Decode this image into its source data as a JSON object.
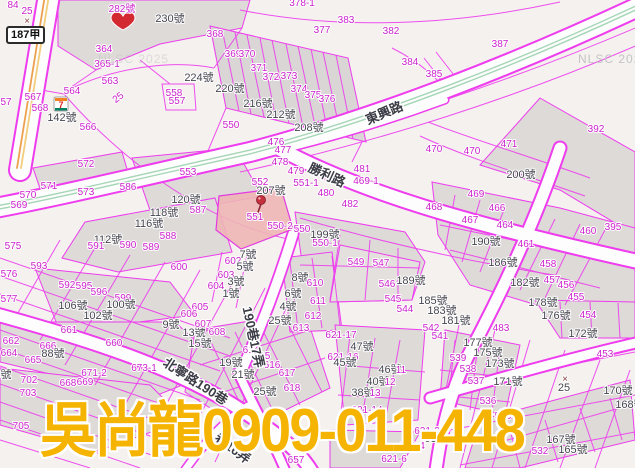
{
  "map": {
    "watermark_big": "吳尚龍0909-011-448",
    "nlsc_watermark": "NLSC 2025",
    "road_sign": "187甲",
    "highlight_parcel": "551",
    "colors": {
      "parcel_line": "#ee3cee",
      "parcel_number": "#cb1fcb",
      "house_number": "#45454f",
      "road_fill": "#fdfdfd",
      "block_fill": "#dddad8",
      "highlight_fill": "#eeb5b5",
      "watermark_gold": "#f6b402",
      "marker_red": "#d32a32",
      "highway_yellow": "#eda14f",
      "center_green": "#a5d6b5",
      "nlsc_gray": "#c4c4c4"
    },
    "markers": [
      {
        "name": "heart-marker",
        "near": "282號"
      },
      {
        "name": "pushpin-marker",
        "near": "551"
      },
      {
        "name": "seven-eleven-store",
        "near": "142號",
        "store_glyph": "7"
      }
    ],
    "labels": [
      {
        "t": "84",
        "x": 13,
        "y": 8,
        "c": "m"
      },
      {
        "t": "25",
        "x": 27,
        "y": 14,
        "c": "m",
        "s": 9
      },
      {
        "t": "×",
        "x": 27,
        "y": 24,
        "c": "x"
      },
      {
        "t": "282號",
        "x": 122,
        "y": 12,
        "c": "m",
        "s": 11
      },
      {
        "t": "230號",
        "x": 170,
        "y": 22,
        "c": "g",
        "s": 12
      },
      {
        "t": "364",
        "x": 104,
        "y": 52,
        "c": "m"
      },
      {
        "t": "365-1",
        "x": 107,
        "y": 67,
        "c": "m"
      },
      {
        "t": "563",
        "x": 110,
        "y": 84,
        "c": "m"
      },
      {
        "t": "564",
        "x": 72,
        "y": 94,
        "c": "m"
      },
      {
        "t": "567",
        "x": 33,
        "y": 100,
        "c": "m"
      },
      {
        "t": "57",
        "x": 6,
        "y": 105,
        "c": "m"
      },
      {
        "t": "568",
        "x": 40,
        "y": 111,
        "c": "m"
      },
      {
        "t": "142號",
        "x": 62,
        "y": 121,
        "c": "g"
      },
      {
        "t": "566",
        "x": 88,
        "y": 130,
        "c": "m"
      },
      {
        "t": "25",
        "x": 120,
        "y": 100,
        "c": "m",
        "s": 9,
        "r": -38
      },
      {
        "t": "558",
        "x": 174,
        "y": 96,
        "c": "m"
      },
      {
        "t": "557",
        "x": 177,
        "y": 104,
        "c": "m"
      },
      {
        "t": "224號",
        "x": 199,
        "y": 81,
        "c": "g"
      },
      {
        "t": "368",
        "x": 215,
        "y": 37,
        "c": "m"
      },
      {
        "t": "369",
        "x": 233,
        "y": 57,
        "c": "m"
      },
      {
        "t": "370",
        "x": 247,
        "y": 57,
        "c": "m"
      },
      {
        "t": "371",
        "x": 259,
        "y": 71,
        "c": "m"
      },
      {
        "t": "372",
        "x": 271,
        "y": 80,
        "c": "m"
      },
      {
        "t": "373",
        "x": 289,
        "y": 79,
        "c": "m"
      },
      {
        "t": "374",
        "x": 299,
        "y": 92,
        "c": "m"
      },
      {
        "t": "375",
        "x": 313,
        "y": 98,
        "c": "m"
      },
      {
        "t": "376",
        "x": 327,
        "y": 102,
        "c": "m"
      },
      {
        "t": "220號",
        "x": 230,
        "y": 92,
        "c": "g"
      },
      {
        "t": "216號",
        "x": 258,
        "y": 107,
        "c": "g"
      },
      {
        "t": "212號",
        "x": 281,
        "y": 118,
        "c": "g"
      },
      {
        "t": "208號",
        "x": 309,
        "y": 131,
        "c": "g"
      },
      {
        "t": "550",
        "x": 231,
        "y": 128,
        "c": "m"
      },
      {
        "t": "378-1",
        "x": 302,
        "y": 6,
        "c": "m"
      },
      {
        "t": "383",
        "x": 346,
        "y": 23,
        "c": "m"
      },
      {
        "t": "377",
        "x": 322,
        "y": 33,
        "c": "m"
      },
      {
        "t": "382",
        "x": 391,
        "y": 34,
        "c": "m"
      },
      {
        "t": "384",
        "x": 410,
        "y": 65,
        "c": "m"
      },
      {
        "t": "476",
        "x": 276,
        "y": 145,
        "c": "m"
      },
      {
        "t": "477",
        "x": 283,
        "y": 153,
        "c": "m"
      },
      {
        "t": "387",
        "x": 500,
        "y": 47,
        "c": "m"
      },
      {
        "t": "385",
        "x": 434,
        "y": 77,
        "c": "m"
      },
      {
        "t": "392",
        "x": 596,
        "y": 132,
        "c": "m"
      },
      {
        "t": "471",
        "x": 509,
        "y": 147,
        "c": "m"
      },
      {
        "t": "470",
        "x": 434,
        "y": 152,
        "c": "m"
      },
      {
        "t": "470",
        "x": 472,
        "y": 154,
        "c": "m"
      },
      {
        "t": "572",
        "x": 86,
        "y": 167,
        "c": "m"
      },
      {
        "t": "553",
        "x": 188,
        "y": 175,
        "c": "m"
      },
      {
        "t": "571",
        "x": 49,
        "y": 189,
        "c": "m"
      },
      {
        "t": "570",
        "x": 28,
        "y": 198,
        "c": "m"
      },
      {
        "t": "569",
        "x": 19,
        "y": 208,
        "c": "m"
      },
      {
        "t": "573",
        "x": 86,
        "y": 195,
        "c": "m"
      },
      {
        "t": "586",
        "x": 128,
        "y": 190,
        "c": "m"
      },
      {
        "t": "587",
        "x": 198,
        "y": 213,
        "c": "m"
      },
      {
        "t": "120號",
        "x": 186,
        "y": 203,
        "c": "g"
      },
      {
        "t": "118號",
        "x": 164,
        "y": 216,
        "c": "g"
      },
      {
        "t": "116號",
        "x": 149,
        "y": 227,
        "c": "g"
      },
      {
        "t": "112號",
        "x": 108,
        "y": 243,
        "c": "g"
      },
      {
        "t": "588",
        "x": 168,
        "y": 239,
        "c": "m"
      },
      {
        "t": "589",
        "x": 151,
        "y": 250,
        "c": "m"
      },
      {
        "t": "590",
        "x": 128,
        "y": 248,
        "c": "m"
      },
      {
        "t": "591",
        "x": 96,
        "y": 249,
        "c": "m"
      },
      {
        "t": "593",
        "x": 39,
        "y": 269,
        "c": "m"
      },
      {
        "t": "575",
        "x": 13,
        "y": 249,
        "c": "m"
      },
      {
        "t": "576",
        "x": 9,
        "y": 277,
        "c": "m"
      },
      {
        "t": "577",
        "x": 9,
        "y": 302,
        "c": "m"
      },
      {
        "t": "592",
        "x": 67,
        "y": 288,
        "c": "m"
      },
      {
        "t": "595",
        "x": 84,
        "y": 289,
        "c": "m"
      },
      {
        "t": "596",
        "x": 99,
        "y": 295,
        "c": "m"
      },
      {
        "t": "599",
        "x": 123,
        "y": 301,
        "c": "m"
      },
      {
        "t": "600",
        "x": 179,
        "y": 270,
        "c": "m"
      },
      {
        "t": "602",
        "x": 233,
        "y": 264,
        "c": "m"
      },
      {
        "t": "603",
        "x": 226,
        "y": 278,
        "c": "m"
      },
      {
        "t": "604",
        "x": 216,
        "y": 289,
        "c": "m"
      },
      {
        "t": "605",
        "x": 200,
        "y": 310,
        "c": "m"
      },
      {
        "t": "106號",
        "x": 73,
        "y": 309,
        "c": "g"
      },
      {
        "t": "100號",
        "x": 121,
        "y": 308,
        "c": "g"
      },
      {
        "t": "7號",
        "x": 248,
        "y": 258,
        "c": "g"
      },
      {
        "t": "5號",
        "x": 245,
        "y": 270,
        "c": "g"
      },
      {
        "t": "3號",
        "x": 236,
        "y": 285,
        "c": "g"
      },
      {
        "t": "1號",
        "x": 231,
        "y": 297,
        "c": "g"
      },
      {
        "t": "8號",
        "x": 300,
        "y": 281,
        "c": "g"
      },
      {
        "t": "6號",
        "x": 293,
        "y": 297,
        "c": "g"
      },
      {
        "t": "4號",
        "x": 288,
        "y": 310,
        "c": "g"
      },
      {
        "t": "478",
        "x": 280,
        "y": 165,
        "c": "m"
      },
      {
        "t": "479",
        "x": 296,
        "y": 174,
        "c": "m"
      },
      {
        "t": "552",
        "x": 260,
        "y": 185,
        "c": "m"
      },
      {
        "t": "551-1",
        "x": 306,
        "y": 186,
        "c": "m"
      },
      {
        "t": "480",
        "x": 326,
        "y": 196,
        "c": "m"
      },
      {
        "t": "481",
        "x": 362,
        "y": 172,
        "c": "m"
      },
      {
        "t": "469-1",
        "x": 366,
        "y": 184,
        "c": "m"
      },
      {
        "t": "482",
        "x": 350,
        "y": 207,
        "c": "m"
      },
      {
        "t": "207號",
        "x": 271,
        "y": 194,
        "c": "g"
      },
      {
        "t": "551",
        "x": 255,
        "y": 220,
        "c": "m",
        "s": 11
      },
      {
        "t": "550-2",
        "x": 280,
        "y": 229,
        "c": "m"
      },
      {
        "t": "550",
        "x": 302,
        "y": 232,
        "c": "m"
      },
      {
        "t": "199號",
        "x": 325,
        "y": 238,
        "c": "g"
      },
      {
        "t": "550-1",
        "x": 325,
        "y": 246,
        "c": "m"
      },
      {
        "t": "549",
        "x": 356,
        "y": 265,
        "c": "m"
      },
      {
        "t": "547",
        "x": 381,
        "y": 266,
        "c": "m"
      },
      {
        "t": "546",
        "x": 387,
        "y": 287,
        "c": "m"
      },
      {
        "t": "545",
        "x": 393,
        "y": 302,
        "c": "m"
      },
      {
        "t": "544",
        "x": 405,
        "y": 312,
        "c": "m"
      },
      {
        "t": "189號",
        "x": 411,
        "y": 284,
        "c": "g"
      },
      {
        "t": "185號",
        "x": 433,
        "y": 304,
        "c": "g"
      },
      {
        "t": "183號",
        "x": 442,
        "y": 314,
        "c": "g"
      },
      {
        "t": "200號",
        "x": 521,
        "y": 178,
        "c": "g"
      },
      {
        "t": "469",
        "x": 476,
        "y": 197,
        "c": "m"
      },
      {
        "t": "468",
        "x": 434,
        "y": 210,
        "c": "m"
      },
      {
        "t": "466",
        "x": 497,
        "y": 211,
        "c": "m"
      },
      {
        "t": "467",
        "x": 470,
        "y": 223,
        "c": "m"
      },
      {
        "t": "464",
        "x": 505,
        "y": 228,
        "c": "m"
      },
      {
        "t": "460",
        "x": 588,
        "y": 234,
        "c": "m"
      },
      {
        "t": "395",
        "x": 613,
        "y": 230,
        "c": "m"
      },
      {
        "t": "461",
        "x": 526,
        "y": 247,
        "c": "m"
      },
      {
        "t": "190號",
        "x": 486,
        "y": 245,
        "c": "g"
      },
      {
        "t": "186號",
        "x": 503,
        "y": 266,
        "c": "g"
      },
      {
        "t": "458",
        "x": 548,
        "y": 267,
        "c": "m"
      },
      {
        "t": "182號",
        "x": 525,
        "y": 286,
        "c": "g"
      },
      {
        "t": "457",
        "x": 552,
        "y": 283,
        "c": "m"
      },
      {
        "t": "456",
        "x": 566,
        "y": 288,
        "c": "m"
      },
      {
        "t": "455",
        "x": 576,
        "y": 300,
        "c": "m"
      },
      {
        "t": "178號",
        "x": 543,
        "y": 306,
        "c": "g"
      },
      {
        "t": "176號",
        "x": 556,
        "y": 319,
        "c": "g"
      },
      {
        "t": "454",
        "x": 588,
        "y": 318,
        "c": "m"
      },
      {
        "t": "172號",
        "x": 583,
        "y": 337,
        "c": "g"
      },
      {
        "t": "453",
        "x": 605,
        "y": 357,
        "c": "m"
      },
      {
        "t": "170號",
        "x": 618,
        "y": 394,
        "c": "g"
      },
      {
        "t": "168號",
        "x": 630,
        "y": 408,
        "c": "g"
      },
      {
        "t": "×",
        "x": 565,
        "y": 382,
        "c": "x"
      },
      {
        "t": "25",
        "x": 564,
        "y": 391,
        "c": "g",
        "s": 9
      },
      {
        "t": "181號",
        "x": 456,
        "y": 324,
        "c": "g"
      },
      {
        "t": "483",
        "x": 501,
        "y": 331,
        "c": "m"
      },
      {
        "t": "542",
        "x": 431,
        "y": 331,
        "c": "m"
      },
      {
        "t": "541",
        "x": 440,
        "y": 339,
        "c": "m"
      },
      {
        "t": "177號",
        "x": 478,
        "y": 346,
        "c": "g"
      },
      {
        "t": "175號",
        "x": 488,
        "y": 356,
        "c": "g"
      },
      {
        "t": "539",
        "x": 458,
        "y": 361,
        "c": "m"
      },
      {
        "t": "173號",
        "x": 500,
        "y": 367,
        "c": "g"
      },
      {
        "t": "538",
        "x": 468,
        "y": 372,
        "c": "m"
      },
      {
        "t": "537",
        "x": 476,
        "y": 384,
        "c": "m"
      },
      {
        "t": "171號",
        "x": 508,
        "y": 385,
        "c": "g"
      },
      {
        "t": "536",
        "x": 488,
        "y": 404,
        "c": "m"
      },
      {
        "t": "535",
        "x": 503,
        "y": 419,
        "c": "m"
      },
      {
        "t": "532",
        "x": 540,
        "y": 454,
        "c": "m"
      },
      {
        "t": "167號",
        "x": 561,
        "y": 443,
        "c": "g"
      },
      {
        "t": "165號",
        "x": 573,
        "y": 453,
        "c": "g"
      },
      {
        "t": "102號",
        "x": 98,
        "y": 319,
        "c": "g"
      },
      {
        "t": "9號",
        "x": 171,
        "y": 328,
        "c": "g"
      },
      {
        "t": "661",
        "x": 69,
        "y": 333,
        "c": "m"
      },
      {
        "t": "13號",
        "x": 194,
        "y": 336,
        "c": "g"
      },
      {
        "t": "662",
        "x": 11,
        "y": 344,
        "c": "m"
      },
      {
        "t": "666",
        "x": 48,
        "y": 349,
        "c": "m"
      },
      {
        "t": "660",
        "x": 114,
        "y": 346,
        "c": "m"
      },
      {
        "t": "664",
        "x": 9,
        "y": 356,
        "c": "m"
      },
      {
        "t": "665",
        "x": 33,
        "y": 363,
        "c": "m"
      },
      {
        "t": "88號",
        "x": 53,
        "y": 357,
        "c": "g"
      },
      {
        "t": "15號",
        "x": 200,
        "y": 347,
        "c": "g"
      },
      {
        "t": "702",
        "x": 29,
        "y": 383,
        "c": "m"
      },
      {
        "t": "703",
        "x": 28,
        "y": 396,
        "c": "m"
      },
      {
        "t": "671-2",
        "x": 94,
        "y": 376,
        "c": "m"
      },
      {
        "t": "673-1",
        "x": 144,
        "y": 371,
        "c": "m"
      },
      {
        "t": "668",
        "x": 68,
        "y": 386,
        "c": "m"
      },
      {
        "t": "669",
        "x": 85,
        "y": 385,
        "c": "m"
      },
      {
        "t": "705",
        "x": 21,
        "y": 429,
        "c": "m"
      },
      {
        "t": "701",
        "x": 68,
        "y": 430,
        "c": "m"
      },
      {
        "t": "94號",
        "x": 78,
        "y": 442,
        "c": "g"
      },
      {
        "t": "6號",
        "x": 3,
        "y": 378,
        "c": "g"
      },
      {
        "t": "606",
        "x": 189,
        "y": 317,
        "c": "m"
      },
      {
        "t": "607",
        "x": 203,
        "y": 327,
        "c": "m"
      },
      {
        "t": "608",
        "x": 217,
        "y": 335,
        "c": "m"
      },
      {
        "t": "612",
        "x": 313,
        "y": 319,
        "c": "m"
      },
      {
        "t": "613",
        "x": 301,
        "y": 331,
        "c": "m"
      },
      {
        "t": "610",
        "x": 315,
        "y": 286,
        "c": "m"
      },
      {
        "t": "611",
        "x": 318,
        "y": 304,
        "c": "m"
      },
      {
        "t": "614",
        "x": 251,
        "y": 353,
        "c": "m"
      },
      {
        "t": "615",
        "x": 262,
        "y": 359,
        "c": "m"
      },
      {
        "t": "616",
        "x": 272,
        "y": 368,
        "c": "m"
      },
      {
        "t": "617",
        "x": 287,
        "y": 376,
        "c": "m"
      },
      {
        "t": "618",
        "x": 292,
        "y": 391,
        "c": "m"
      },
      {
        "t": "19號",
        "x": 231,
        "y": 366,
        "c": "g"
      },
      {
        "t": "21號",
        "x": 243,
        "y": 378,
        "c": "g"
      },
      {
        "t": "25號",
        "x": 265,
        "y": 395,
        "c": "g"
      },
      {
        "t": "25號",
        "x": 280,
        "y": 324,
        "c": "g"
      },
      {
        "t": "621-17",
        "x": 341,
        "y": 338,
        "c": "m"
      },
      {
        "t": "621-16",
        "x": 343,
        "y": 360,
        "c": "m"
      },
      {
        "t": "47號",
        "x": 362,
        "y": 350,
        "c": "g"
      },
      {
        "t": "45號",
        "x": 345,
        "y": 366,
        "c": "g"
      },
      {
        "t": "46號",
        "x": 390,
        "y": 373,
        "c": "g"
      },
      {
        "t": "40號",
        "x": 378,
        "y": 385,
        "c": "g"
      },
      {
        "t": "38號",
        "x": 363,
        "y": 396,
        "c": "g"
      },
      {
        "t": "11",
        "x": 401,
        "y": 373,
        "c": "m",
        "s": 8
      },
      {
        "t": "12",
        "x": 390,
        "y": 385,
        "c": "m",
        "s": 8
      },
      {
        "t": "13",
        "x": 375,
        "y": 396,
        "c": "m",
        "s": 8
      },
      {
        "t": "621-14",
        "x": 367,
        "y": 413,
        "c": "m"
      },
      {
        "t": "621-3",
        "x": 427,
        "y": 434,
        "c": "m"
      },
      {
        "t": "63號",
        "x": 436,
        "y": 442,
        "c": "g"
      },
      {
        "t": "621-4",
        "x": 412,
        "y": 449,
        "c": "m"
      },
      {
        "t": "621-6",
        "x": 394,
        "y": 462,
        "c": "m"
      },
      {
        "t": "657",
        "x": 296,
        "y": 463,
        "c": "m"
      },
      {
        "t": "東興路",
        "x": 386,
        "y": 117,
        "c": "r",
        "s": 14,
        "r": -23
      },
      {
        "t": "勝利路",
        "x": 325,
        "y": 179,
        "c": "r",
        "s": 14,
        "r": 25
      },
      {
        "t": "北寧路190巷",
        "x": 193,
        "y": 385,
        "c": "r",
        "s": 13,
        "r": 33
      },
      {
        "t": "190巷17弄",
        "x": 249,
        "y": 338,
        "c": "r",
        "s": 10,
        "r": 78
      },
      {
        "t": "巷16弄",
        "x": 230,
        "y": 452,
        "c": "r",
        "s": 10,
        "r": 36
      }
    ]
  }
}
